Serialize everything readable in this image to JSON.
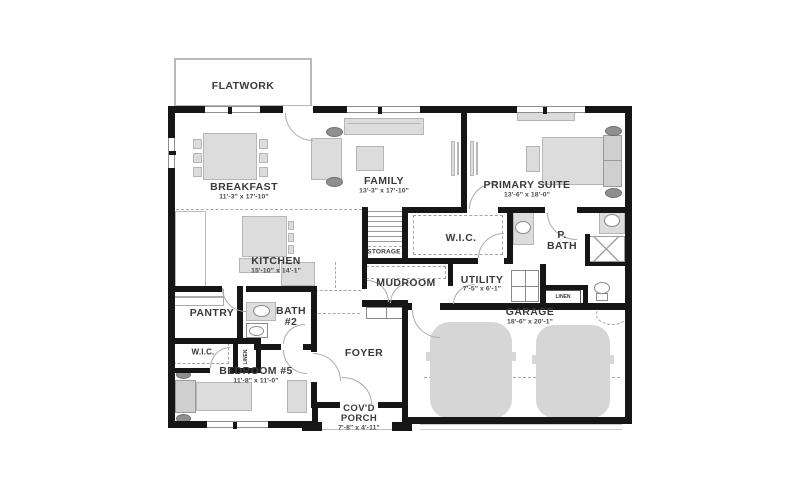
{
  "labels": {
    "flatwork": "FLATWORK",
    "breakfast": {
      "name": "BREAKFAST",
      "dims": "11'-3\" x 17'-10\""
    },
    "family": {
      "name": "FAMILY",
      "dims": "13'-3\" x 17'-10\""
    },
    "primary_suite": {
      "name": "PRIMARY SUITE",
      "dims": "13'-6\" x 18'-0\""
    },
    "kitchen": {
      "name": "KITCHEN",
      "dims": "15'-10\" x 14'-1\""
    },
    "storage": {
      "name": "STORAGE"
    },
    "wic_primary": {
      "name": "W.I.C."
    },
    "primary_bath": {
      "name": "P. BATH"
    },
    "mudroom": {
      "name": "MUDROOM"
    },
    "utility": {
      "name": "UTILITY",
      "dims": "7'-5\" x 6'-1\""
    },
    "linen_hall": {
      "name": "LINEN"
    },
    "garage": {
      "name": "GARAGE",
      "dims": "18'-6\" x 20'-1\""
    },
    "pantry": {
      "name": "PANTRY"
    },
    "bath_2": {
      "name": "BATH #2"
    },
    "wic_bedroom5": {
      "name": "W.I.C."
    },
    "linen_bedroom5": {
      "name": "LINEN"
    },
    "bedroom_5": {
      "name": "BEDROOM #5",
      "dims": "11'-8\" x 11'-0\""
    },
    "foyer": {
      "name": "FOYER"
    },
    "covered_porch": {
      "name": "COV'D PORCH",
      "dims": "7'-8\" x 4'-11\""
    }
  }
}
